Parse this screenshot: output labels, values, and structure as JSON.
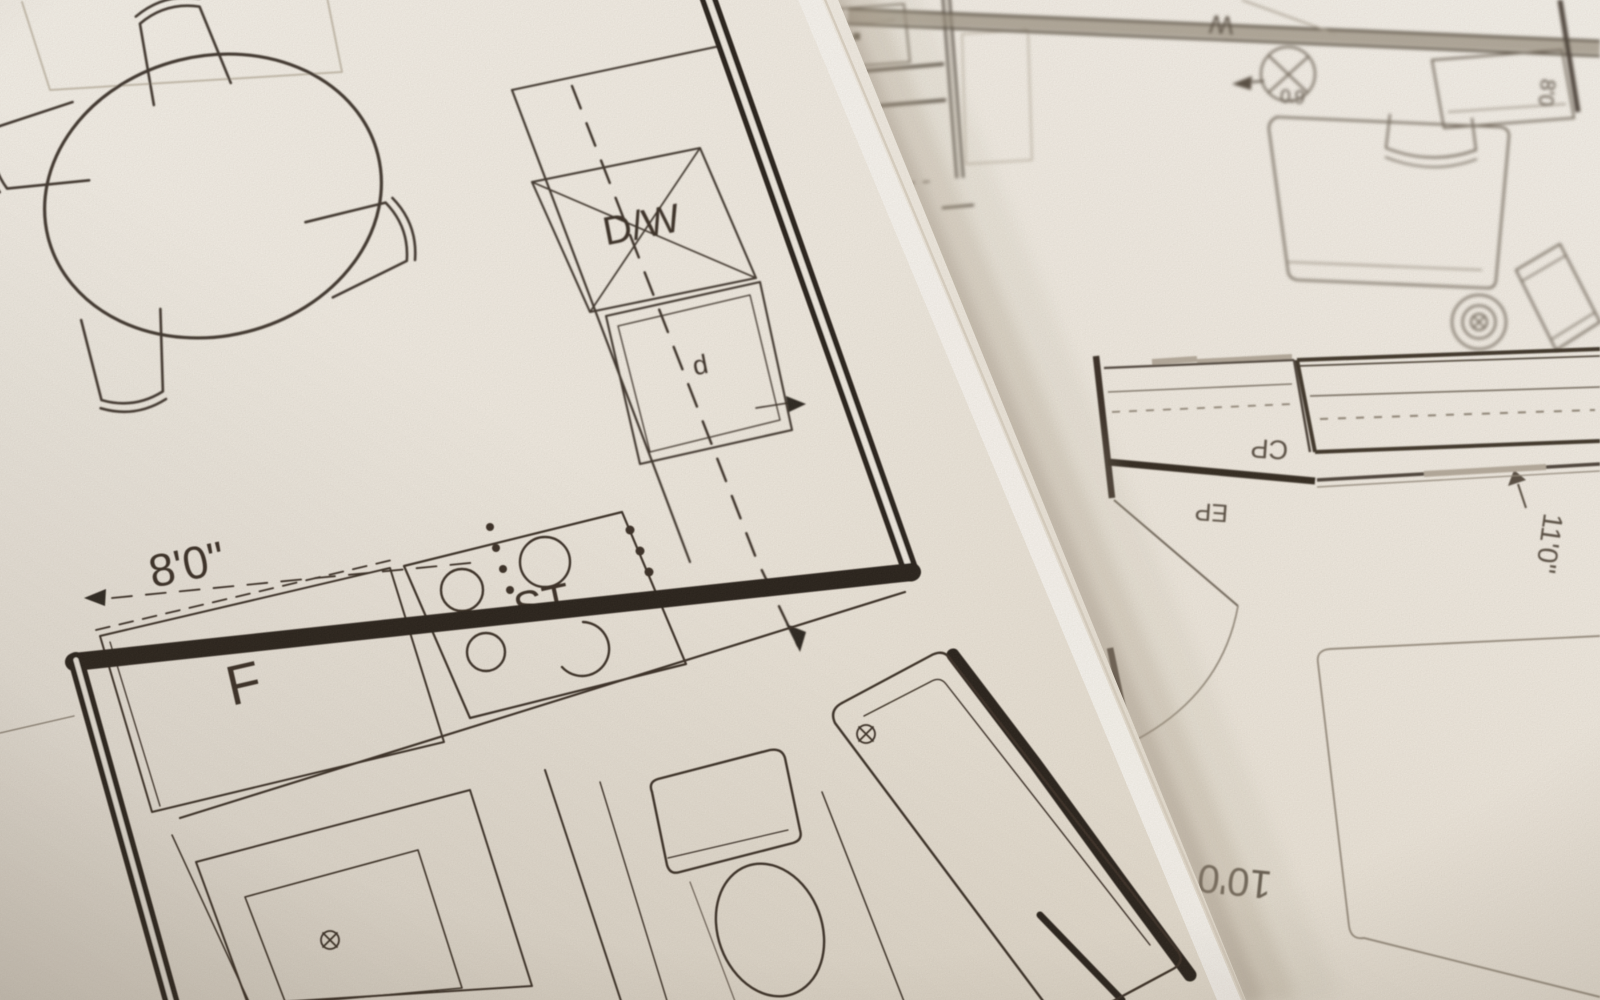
{
  "left_plan": {
    "labels": {
      "dishwasher": "D/W",
      "sink": "d",
      "stove": "ST",
      "refrigerator": "F",
      "dim_width": "8'0\""
    }
  },
  "right_plan": {
    "labels": {
      "wardrobe": "W",
      "refrigerator": "F",
      "dim_small": "6'0",
      "dim_side": "8'0",
      "closet": "CP",
      "panel": "EP",
      "dim_vertical": "11'0\"",
      "dim_bottom": "10'0"
    }
  }
}
